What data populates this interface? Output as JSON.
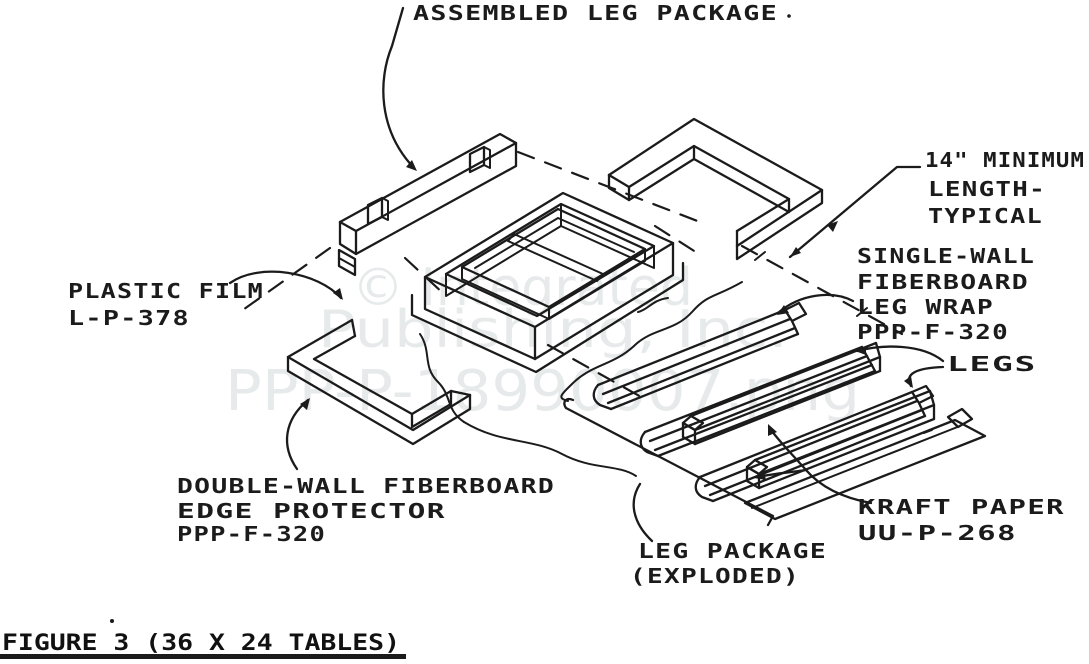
{
  "drawing": {
    "labels": {
      "assembled_leg_package": "ASSEMBLED LEG PACKAGE",
      "min_length": [
        "14\" MINIMUM",
        "LENGTH-",
        "TYPICAL"
      ],
      "leg_wrap": [
        "SINGLE-WALL",
        "FIBERBOARD",
        "LEG WRAP",
        "PPP-F-320"
      ],
      "legs": "LEGS",
      "plastic_film": [
        "PLASTIC FILM",
        "L-P-378"
      ],
      "edge_protector": [
        "DOUBLE-WALL FIBERBOARD",
        "EDGE PROTECTOR",
        "PPP-F-320"
      ],
      "kraft_paper": [
        "KRAFT PAPER",
        "UU-P-268"
      ],
      "leg_package_exploded": [
        "LEG PACKAGE",
        "(EXPLODED)"
      ]
    },
    "caption": "FIGURE 3 (36 X 24 TABLES)",
    "watermark": [
      "© Integrated",
      "Publishing, Inc.",
      "PPP-P-18990007.png"
    ],
    "colors": {
      "ink": "#1b1b1b",
      "watermark": "#e7eaeb",
      "background": "#ffffff"
    }
  }
}
